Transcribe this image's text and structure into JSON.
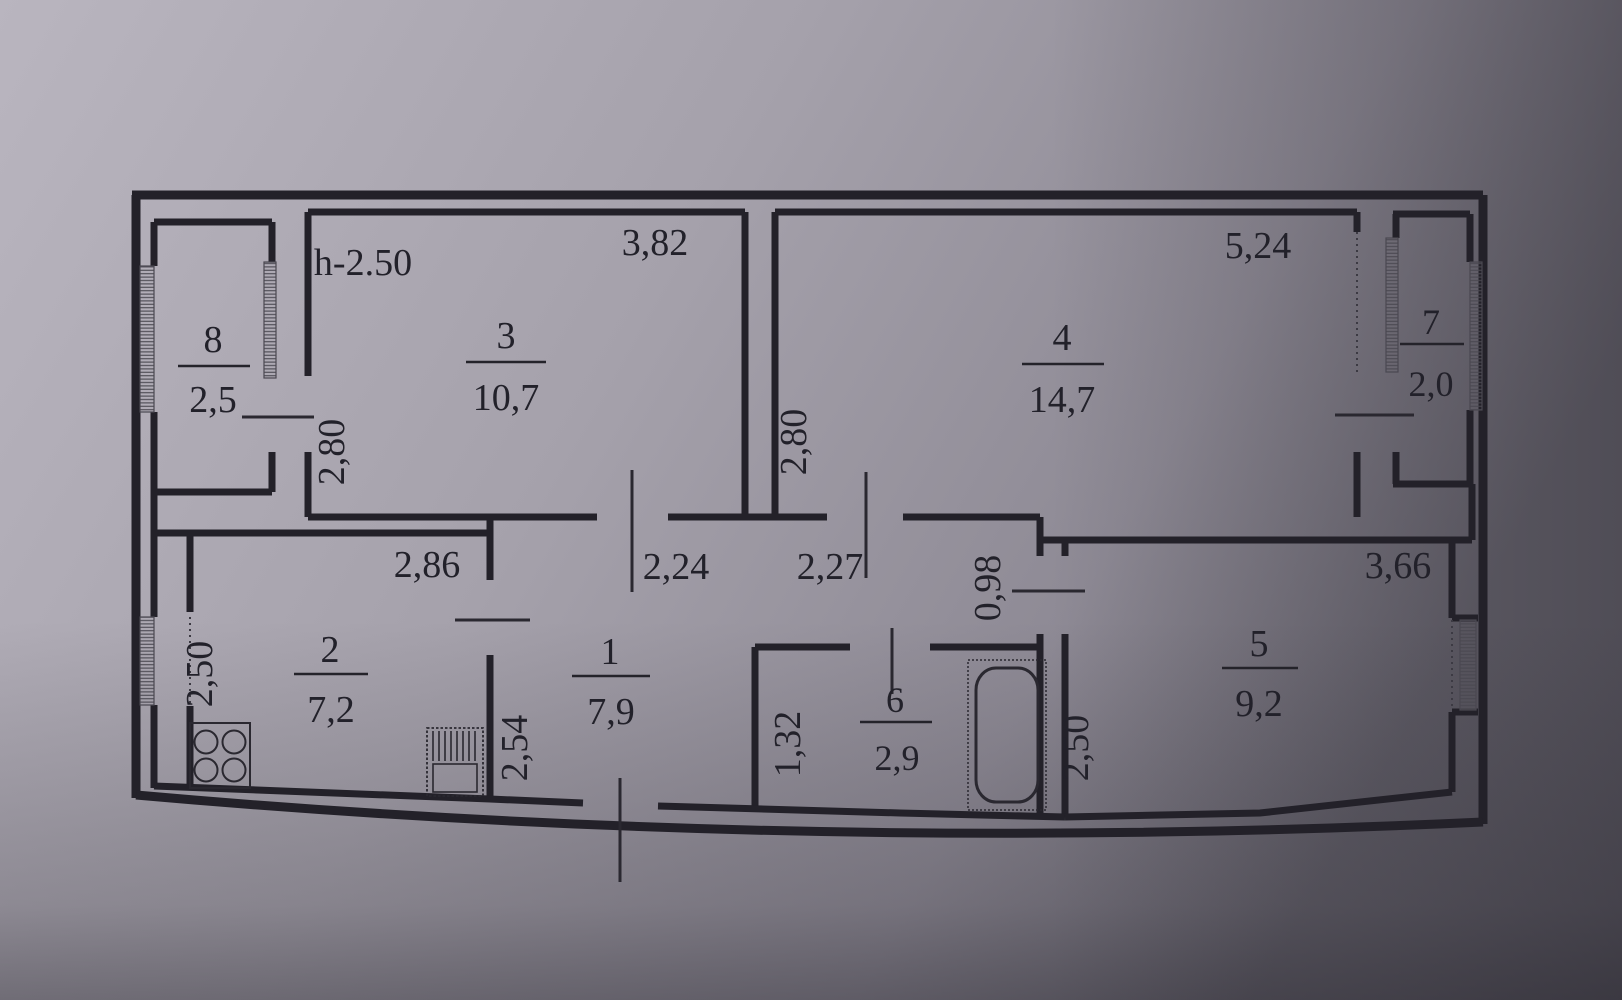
{
  "plan": {
    "title": "apartment-floor-plan",
    "height_note": "h-2.50",
    "wall_color": "#232129",
    "paper_color_light": "#b8b4be",
    "paper_color_dark": "#5f5c66"
  },
  "rooms": {
    "r1": {
      "number": "1",
      "area": "7,9"
    },
    "r2": {
      "number": "2",
      "area": "7,2"
    },
    "r3": {
      "number": "3",
      "area": "10,7"
    },
    "r4": {
      "number": "4",
      "area": "14,7"
    },
    "r5": {
      "number": "5",
      "area": "9,2"
    },
    "r6": {
      "number": "6",
      "area": "2,9"
    },
    "r7": {
      "number": "7",
      "area": "2,0"
    },
    "r8": {
      "number": "8",
      "area": "2,5"
    }
  },
  "dimensions": {
    "room3_width": "3,82",
    "room3_depth": "2,80",
    "room4_width": "5,24",
    "room4_depth": "2,80",
    "room5_width": "3,66",
    "room5_depth": "2,50",
    "kitchen_width": "2,86",
    "kitchen_depth": "2,50",
    "hall_left": "2,24",
    "hall_right": "2,27",
    "hall_depth": "2,54",
    "bath_depth": "1,32",
    "passage": "0,98"
  }
}
